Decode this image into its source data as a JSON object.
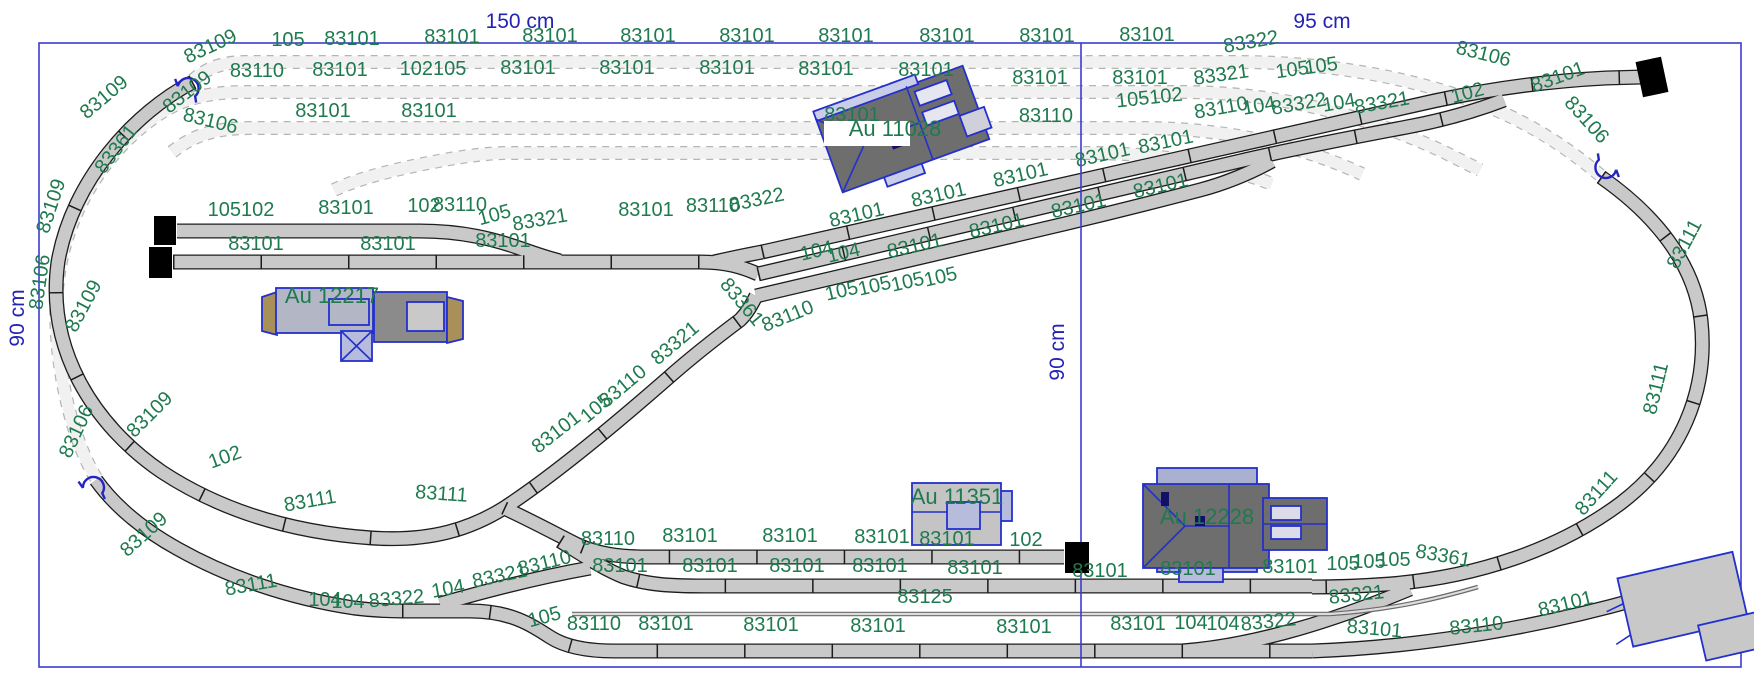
{
  "title": "track-plan",
  "colors": {
    "board_border": "#3b3bd0",
    "dimension_text": "#2424b4",
    "part_label_green": "#1f7a4f",
    "track_fill": "#c9c9c9",
    "track_outline": "#1c1c1c",
    "hidden_track_fill": "#f1f1f1",
    "hidden_track_dash": "#b5b5b5",
    "building_outline": "#2330cc",
    "roof_dark": "#6e6e6e",
    "building_light": "#c4c4c4",
    "building_slate": "#b7bcdc",
    "building_tan": "#a89058",
    "buffer_stop": "#000000"
  },
  "dimension_labels": [
    {
      "t": "150 cm",
      "x": 520,
      "y": 28
    },
    {
      "t": "95 cm",
      "x": 1322,
      "y": 28
    },
    {
      "t": "90 cm",
      "x": 24,
      "y": 318,
      "r": -90
    },
    {
      "t": "90 cm",
      "x": 1064,
      "y": 352,
      "r": -90
    }
  ],
  "building_labels": [
    {
      "t": "Au 12217",
      "x": 332,
      "y": 303
    },
    {
      "t": "Au 11028",
      "x": 895,
      "y": 136
    },
    {
      "t": "Au 11351",
      "x": 957,
      "y": 504
    },
    {
      "t": "Au 12228",
      "x": 1207,
      "y": 524
    }
  ],
  "track_labels": [
    {
      "t": "83109",
      "x": 213,
      "y": 52,
      "r": -25
    },
    {
      "t": "105",
      "x": 288,
      "y": 46
    },
    {
      "t": "83101",
      "x": 352,
      "y": 45
    },
    {
      "t": "83101",
      "x": 452,
      "y": 43
    },
    {
      "t": "83101",
      "x": 550,
      "y": 42
    },
    {
      "t": "83101",
      "x": 648,
      "y": 42
    },
    {
      "t": "83101",
      "x": 747,
      "y": 42
    },
    {
      "t": "83101",
      "x": 846,
      "y": 42
    },
    {
      "t": "83101",
      "x": 947,
      "y": 42
    },
    {
      "t": "83101",
      "x": 1047,
      "y": 42
    },
    {
      "t": "83101",
      "x": 1147,
      "y": 41
    },
    {
      "t": "83322",
      "x": 1252,
      "y": 48,
      "r": -10
    },
    {
      "t": "83106",
      "x": 1482,
      "y": 60,
      "r": 14
    },
    {
      "t": "83109",
      "x": 191,
      "y": 97,
      "r": -38
    },
    {
      "t": "83110",
      "x": 257,
      "y": 77
    },
    {
      "t": "83101",
      "x": 340,
      "y": 76
    },
    {
      "t": "102105",
      "x": 433,
      "y": 75
    },
    {
      "t": "83101",
      "x": 528,
      "y": 74
    },
    {
      "t": "83101",
      "x": 627,
      "y": 74
    },
    {
      "t": "83101",
      "x": 727,
      "y": 74
    },
    {
      "t": "83101",
      "x": 826,
      "y": 75
    },
    {
      "t": "83101",
      "x": 926,
      "y": 76
    },
    {
      "t": "83101",
      "x": 1040,
      "y": 84
    },
    {
      "t": "83101",
      "x": 1140,
      "y": 84
    },
    {
      "t": "83321",
      "x": 1222,
      "y": 81,
      "r": -8
    },
    {
      "t": "105",
      "x": 1293,
      "y": 76,
      "r": -8
    },
    {
      "t": "105",
      "x": 1322,
      "y": 72,
      "r": -8
    },
    {
      "t": "83101",
      "x": 1560,
      "y": 83,
      "r": -20
    },
    {
      "t": "83106",
      "x": 209,
      "y": 127,
      "r": 14
    },
    {
      "t": "83101",
      "x": 323,
      "y": 117
    },
    {
      "t": "83101",
      "x": 429,
      "y": 117
    },
    {
      "t": "83101",
      "x": 852,
      "y": 121
    },
    {
      "t": "83110",
      "x": 1046,
      "y": 122
    },
    {
      "t": "105102",
      "x": 1150,
      "y": 104,
      "r": -6
    },
    {
      "t": "83101",
      "x": 1167,
      "y": 148,
      "r": -12
    },
    {
      "t": "83110",
      "x": 1222,
      "y": 114,
      "r": -10
    },
    {
      "t": "104",
      "x": 1260,
      "y": 112,
      "r": -10
    },
    {
      "t": "83322",
      "x": 1300,
      "y": 110,
      "r": -10
    },
    {
      "t": "104",
      "x": 1340,
      "y": 109,
      "r": -10
    },
    {
      "t": "83321",
      "x": 1383,
      "y": 109,
      "r": -10
    },
    {
      "t": "102",
      "x": 1469,
      "y": 99,
      "r": -15
    },
    {
      "t": "83106",
      "x": 1582,
      "y": 124,
      "r": 48
    },
    {
      "t": "83101",
      "x": 858,
      "y": 221,
      "r": -13
    },
    {
      "t": "83101",
      "x": 940,
      "y": 201,
      "r": -13
    },
    {
      "t": "83101",
      "x": 1022,
      "y": 181,
      "r": -13
    },
    {
      "t": "83101",
      "x": 1104,
      "y": 161,
      "r": -13
    },
    {
      "t": "83101",
      "x": 916,
      "y": 252,
      "r": -13
    },
    {
      "t": "83101",
      "x": 998,
      "y": 232,
      "r": -13
    },
    {
      "t": "83101",
      "x": 1080,
      "y": 212,
      "r": -13
    },
    {
      "t": "83101",
      "x": 1162,
      "y": 192,
      "r": -13
    },
    {
      "t": "83361",
      "x": 737,
      "y": 306,
      "r": 50
    },
    {
      "t": "104",
      "x": 818,
      "y": 257,
      "r": -13
    },
    {
      "t": "104",
      "x": 845,
      "y": 259,
      "r": -13
    },
    {
      "t": "105",
      "x": 843,
      "y": 297,
      "r": -13
    },
    {
      "t": "105",
      "x": 876,
      "y": 292,
      "r": -13
    },
    {
      "t": "105",
      "x": 909,
      "y": 288,
      "r": -13
    },
    {
      "t": "105",
      "x": 942,
      "y": 283,
      "r": -13
    },
    {
      "t": "83110",
      "x": 790,
      "y": 322,
      "r": -22
    },
    {
      "t": "83321",
      "x": 679,
      "y": 348,
      "r": -40
    },
    {
      "t": "83110",
      "x": 627,
      "y": 391,
      "r": -40
    },
    {
      "t": "105",
      "x": 600,
      "y": 413,
      "r": -40
    },
    {
      "t": "83101",
      "x": 560,
      "y": 437,
      "r": -38
    },
    {
      "t": "105102",
      "x": 241,
      "y": 216
    },
    {
      "t": "83101",
      "x": 346,
      "y": 214
    },
    {
      "t": "102",
      "x": 424,
      "y": 212
    },
    {
      "t": "83110",
      "x": 460,
      "y": 211
    },
    {
      "t": "105",
      "x": 496,
      "y": 221,
      "r": -15
    },
    {
      "t": "83321",
      "x": 541,
      "y": 226,
      "r": -10
    },
    {
      "t": "83101",
      "x": 646,
      "y": 216
    },
    {
      "t": "83110",
      "x": 713,
      "y": 212
    },
    {
      "t": "83322",
      "x": 758,
      "y": 206,
      "r": -12
    },
    {
      "t": "83101",
      "x": 256,
      "y": 250
    },
    {
      "t": "83101",
      "x": 388,
      "y": 250
    },
    {
      "t": "83101",
      "x": 503,
      "y": 247
    },
    {
      "t": "83109",
      "x": 108,
      "y": 102,
      "r": -40
    },
    {
      "t": "83361",
      "x": 121,
      "y": 153,
      "r": -52
    },
    {
      "t": "83109",
      "x": 57,
      "y": 208,
      "r": -72
    },
    {
      "t": "83106",
      "x": 46,
      "y": 283,
      "r": -82
    },
    {
      "t": "83109",
      "x": 89,
      "y": 309,
      "r": -62
    },
    {
      "t": "83106",
      "x": 82,
      "y": 434,
      "r": -65
    },
    {
      "t": "83109",
      "x": 154,
      "y": 419,
      "r": -45
    },
    {
      "t": "102",
      "x": 227,
      "y": 463,
      "r": -20
    },
    {
      "t": "83111",
      "x": 311,
      "y": 507,
      "r": -10
    },
    {
      "t": "83111",
      "x": 441,
      "y": 500,
      "r": 4
    },
    {
      "t": "83109",
      "x": 148,
      "y": 539,
      "r": -42
    },
    {
      "t": "83111",
      "x": 252,
      "y": 591,
      "r": -10
    },
    {
      "t": "104",
      "x": 325,
      "y": 606
    },
    {
      "t": "104",
      "x": 348,
      "y": 608
    },
    {
      "t": "83322",
      "x": 397,
      "y": 605,
      "r": -5
    },
    {
      "t": "104",
      "x": 449,
      "y": 595,
      "r": -10
    },
    {
      "t": "83321",
      "x": 501,
      "y": 582,
      "r": -12
    },
    {
      "t": "83110",
      "x": 546,
      "y": 569,
      "r": -14
    },
    {
      "t": "105",
      "x": 546,
      "y": 623,
      "r": -15
    },
    {
      "t": "83110",
      "x": 594,
      "y": 630
    },
    {
      "t": "83110",
      "x": 608,
      "y": 545
    },
    {
      "t": "83101",
      "x": 690,
      "y": 542
    },
    {
      "t": "83101",
      "x": 790,
      "y": 542
    },
    {
      "t": "83101",
      "x": 882,
      "y": 543
    },
    {
      "t": "83101",
      "x": 947,
      "y": 545
    },
    {
      "t": "102",
      "x": 1026,
      "y": 546
    },
    {
      "t": "83101",
      "x": 620,
      "y": 572
    },
    {
      "t": "83101",
      "x": 710,
      "y": 572
    },
    {
      "t": "83101",
      "x": 797,
      "y": 572
    },
    {
      "t": "83101",
      "x": 880,
      "y": 572
    },
    {
      "t": "83101",
      "x": 975,
      "y": 574
    },
    {
      "t": "83101",
      "x": 1100,
      "y": 577
    },
    {
      "t": "83101",
      "x": 1188,
      "y": 575
    },
    {
      "t": "83101",
      "x": 1290,
      "y": 573
    },
    {
      "t": "105",
      "x": 1343,
      "y": 570
    },
    {
      "t": "105",
      "x": 1369,
      "y": 568
    },
    {
      "t": "105",
      "x": 1394,
      "y": 566
    },
    {
      "t": "83361",
      "x": 1442,
      "y": 562,
      "r": 10
    },
    {
      "t": "83125",
      "x": 925,
      "y": 603
    },
    {
      "t": "83321",
      "x": 1357,
      "y": 601,
      "r": -6
    },
    {
      "t": "83101",
      "x": 666,
      "y": 630
    },
    {
      "t": "83101",
      "x": 771,
      "y": 631
    },
    {
      "t": "83101",
      "x": 878,
      "y": 632
    },
    {
      "t": "83101",
      "x": 1024,
      "y": 633
    },
    {
      "t": "83101",
      "x": 1138,
      "y": 630
    },
    {
      "t": "104",
      "x": 1191,
      "y": 629
    },
    {
      "t": "104",
      "x": 1223,
      "y": 630
    },
    {
      "t": "83322",
      "x": 1269,
      "y": 628,
      "r": -6
    },
    {
      "t": "83101",
      "x": 1374,
      "y": 635,
      "r": 5
    },
    {
      "t": "83110",
      "x": 1477,
      "y": 632,
      "r": -6
    },
    {
      "t": "83101",
      "x": 1567,
      "y": 610,
      "r": -14
    },
    {
      "t": "83111",
      "x": 1690,
      "y": 247,
      "r": -62
    },
    {
      "t": "83111",
      "x": 1662,
      "y": 390,
      "r": -76
    },
    {
      "t": "83111",
      "x": 1601,
      "y": 497,
      "r": -48
    }
  ]
}
